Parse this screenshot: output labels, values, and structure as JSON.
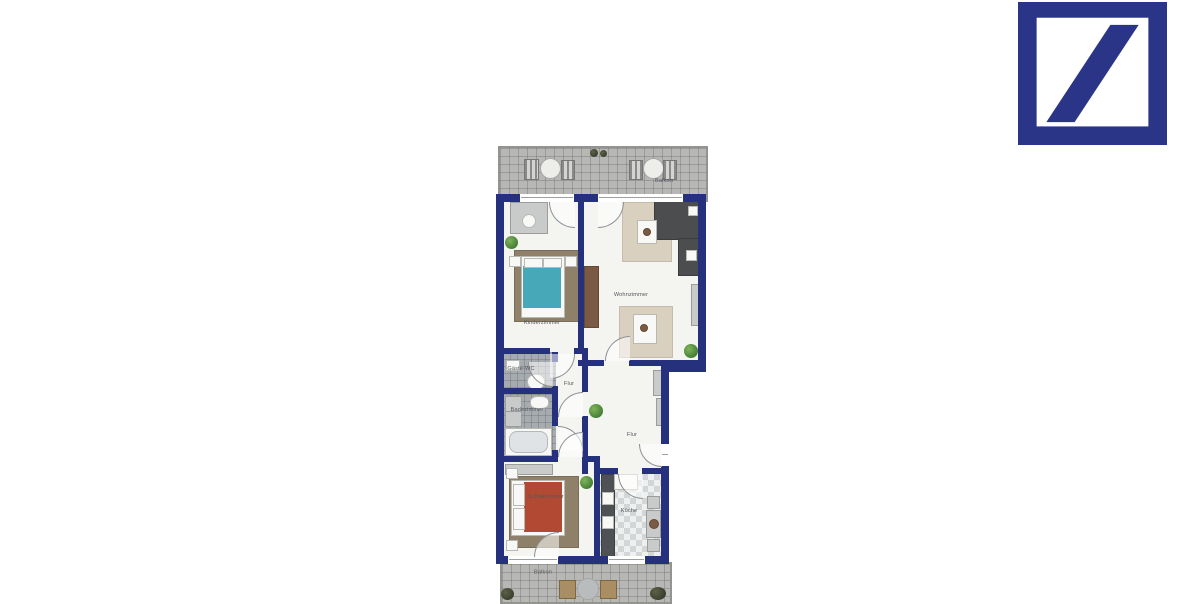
{
  "colors": {
    "wall": "#26317E",
    "logo_blue": "#2B3588",
    "floor": "#F4F4F1",
    "balcony_tile": "#B7B7B5",
    "bath_tile": "#A6ABB0",
    "carpet": "#8F8169",
    "rug": "#D9D0C0",
    "bed_teal": "#47A9B8",
    "bed_red": "#B24A33",
    "sofa_dark": "#4B4D4F",
    "wood_brown": "#7B5A45"
  },
  "icons": {
    "logo": "deutsche-bank-slash"
  },
  "floorplan": {
    "rooms": {
      "balkon_top": {
        "label": "Balkon"
      },
      "kinderzimmer": {
        "label": "Kinderzimmer"
      },
      "wohnzimmer": {
        "label": "Wohnzimmer"
      },
      "gaeste_wc": {
        "label": "Gäste-WC"
      },
      "flur_klein": {
        "label": "Flur"
      },
      "badezimmer": {
        "label": "Badezimmer"
      },
      "flur": {
        "label": "Flur"
      },
      "schlafzimmer": {
        "label": "Schlafzimmer"
      },
      "kueche": {
        "label": "Küche"
      },
      "balkon_bottom": {
        "label": "Balkon"
      }
    }
  }
}
